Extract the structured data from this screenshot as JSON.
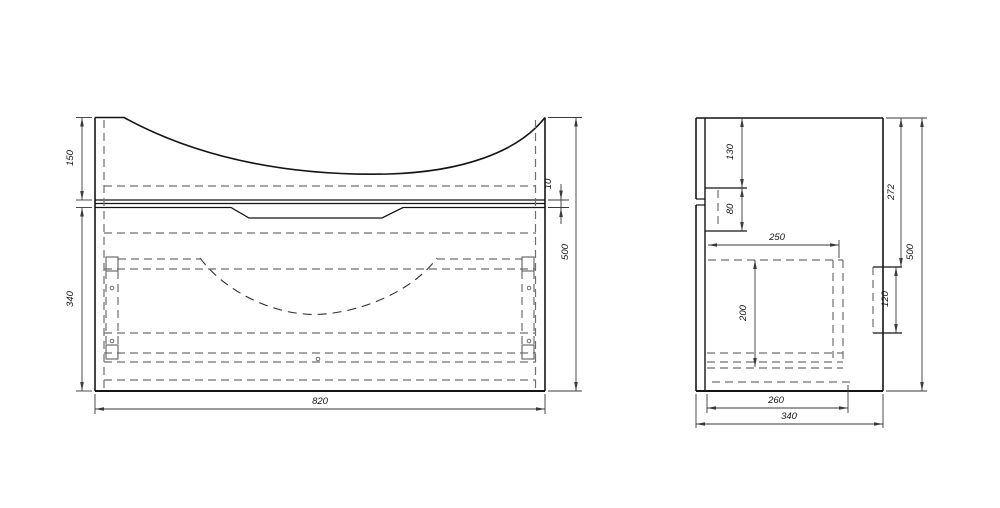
{
  "drawing": {
    "type": "technical-drawing-cabinet",
    "views": {
      "front": {
        "label": "front-view",
        "dims": {
          "top_section_height": "150",
          "front_gap": "10",
          "drawer_front_height": "340",
          "width": "820",
          "total_height": "500"
        }
      },
      "side": {
        "label": "side-view",
        "dims": {
          "front_rail_offset": "130",
          "front_rail_height": "80",
          "drawer_depth": "250",
          "drawer_inner_height": "200",
          "mount_cutout_offset": "272",
          "mount_cutout_height": "120",
          "bottom_panel_depth": "260",
          "total_depth": "340",
          "total_height": "500"
        }
      }
    },
    "colors": {
      "outline": "#141414",
      "hidden_line": "#6f6f6f",
      "dimension_line": "#3a3a3a",
      "background": "#ffffff"
    }
  }
}
